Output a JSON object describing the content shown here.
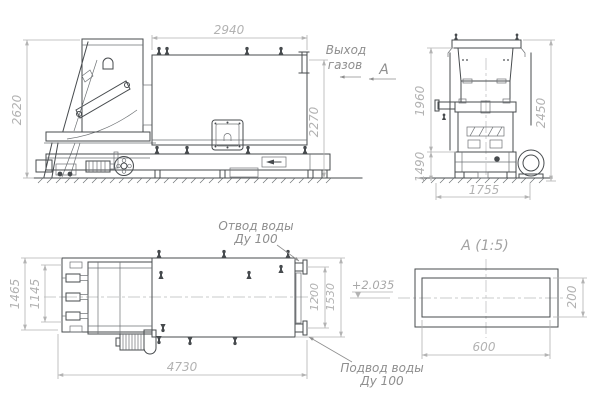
{
  "colors": {
    "machine_line": "#474b4e",
    "dimension_line": "#b3b3b3",
    "dimension_text": "#b2b2b2",
    "annotation_text": "#8e8e8e"
  },
  "side_view": {
    "dim_width": "2940",
    "dim_height_left": "2620",
    "dim_height_right": "2270",
    "gas_outlet": {
      "line1": "Выход",
      "line2": "газов"
    },
    "section_arrow_label": "А"
  },
  "front_view": {
    "dim_body_height": "1960",
    "dim_total_height": "2450",
    "dim_base_height": "1490",
    "dim_width": "1755"
  },
  "plan_view": {
    "dim_feeder_outer": "1465",
    "dim_feeder_inner": "1145",
    "dim_length": "4730",
    "dim_flange_span": "1200",
    "dim_body_width": "1530",
    "water_outlet": {
      "line1": "Отвод воды",
      "line2": "Ду 100"
    },
    "water_inlet": {
      "line1": "Подвод воды",
      "line2": "Ду 100"
    },
    "level_mark": "+2.035"
  },
  "section_view": {
    "title": "А  (1:5)",
    "dim_width": "600",
    "dim_height": "200"
  }
}
